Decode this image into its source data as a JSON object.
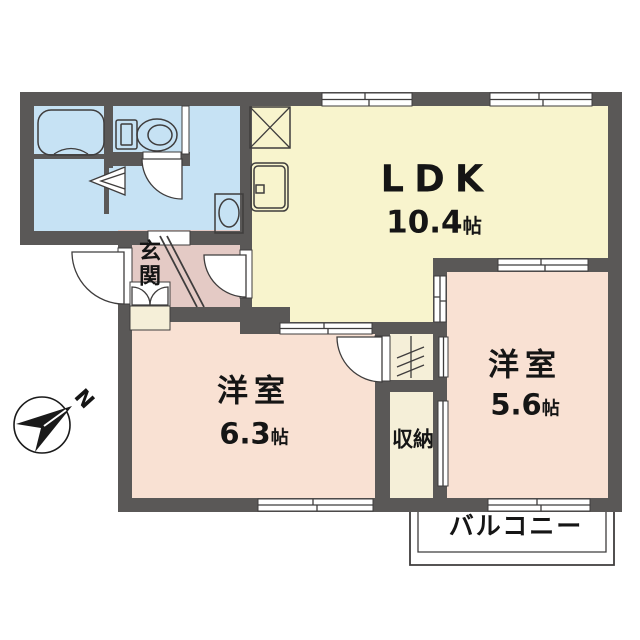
{
  "rooms": {
    "ldk": {
      "name": "LDK",
      "area": "10.4",
      "unit": "帖"
    },
    "bedroom_left": {
      "name": "洋室",
      "area": "6.3",
      "unit": "帖"
    },
    "bedroom_right": {
      "name": "洋室",
      "area": "5.6",
      "unit": "帖"
    },
    "entrance": {
      "name": "玄関"
    },
    "storage": {
      "name": "収納"
    },
    "balcony": {
      "name": "バルコニー"
    }
  },
  "compass": {
    "north_label": "N"
  },
  "icons": [
    "bathtub-icon",
    "toilet-icon",
    "folding-door-icon",
    "washing-machine-icon",
    "refrigerator-space-icon",
    "kitchen-sink-icon",
    "shoe-cabinet-icon",
    "closet-hatch-icon",
    "compass-icon"
  ],
  "colors": {
    "wall": "#5a5857",
    "wet_area": "#c6e2f4",
    "ldk": "#f8f4cd",
    "bedroom": "#f9e1d3",
    "entrance": "#e4cac5",
    "closet": "#f5efd8",
    "line": "#3f3d3d"
  }
}
